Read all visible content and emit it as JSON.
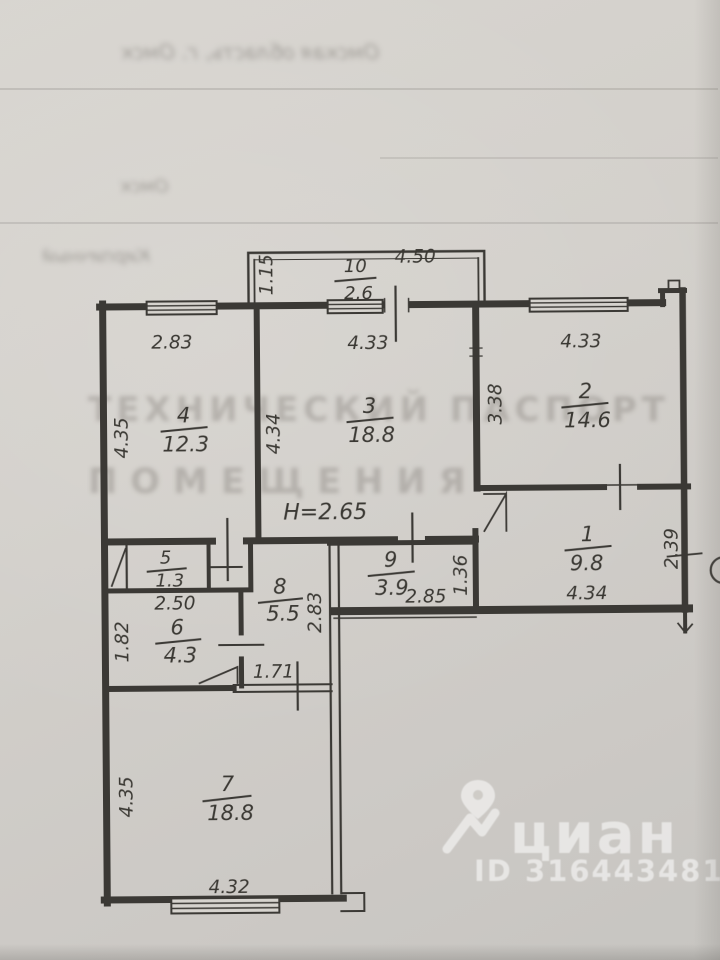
{
  "palette": {
    "paper": "#d4d1cc",
    "ink": "#3b3935",
    "watermark": "#ffffff"
  },
  "watermark": {
    "brand": "циан",
    "listing_id": "ID 316443481"
  },
  "plan": {
    "ceiling_height": "H=2.65",
    "rooms": {
      "r1": {
        "num": "1",
        "area": "9.8"
      },
      "r2": {
        "num": "2",
        "area": "14.6"
      },
      "r3": {
        "num": "3",
        "area": "18.8"
      },
      "r4": {
        "num": "4",
        "area": "12.3"
      },
      "r5": {
        "num": "5",
        "area": "1.3"
      },
      "r6": {
        "num": "6",
        "area": "4.3"
      },
      "r7": {
        "num": "7",
        "area": "18.8"
      },
      "r8": {
        "num": "8",
        "area": "5.5"
      },
      "r9": {
        "num": "9",
        "area": "3.9"
      },
      "r10": {
        "num": "10",
        "area": "2.6"
      }
    },
    "dims": {
      "balcony_width": "4.50",
      "balcony_depth": "1.15",
      "r4_top": "2.83",
      "r4_left": "4.35",
      "r3_top": "4.33",
      "r3_left": "4.34",
      "r2_top": "4.33",
      "r2_left": "3.38",
      "r1_right": "2.39",
      "r1_bottom": "4.34",
      "r9_bottom": "2.85",
      "r9_right": "1.36",
      "r6_top": "2.50",
      "r6_left": "1.82",
      "hall8_right": "2.83",
      "opening_bottom": "1.71",
      "r7_left": "4.35",
      "r7_bottom": "4.32"
    }
  },
  "bleedthrough": {
    "top_row": "Омская область, г. Омск",
    "city": "Омск",
    "material": "Кирпичный",
    "stamp_line1": "ТЕХНИЧЕСКИЙ ПАСПОРТ",
    "stamp_line2": "ПОМЕЩЕНИЯ"
  }
}
